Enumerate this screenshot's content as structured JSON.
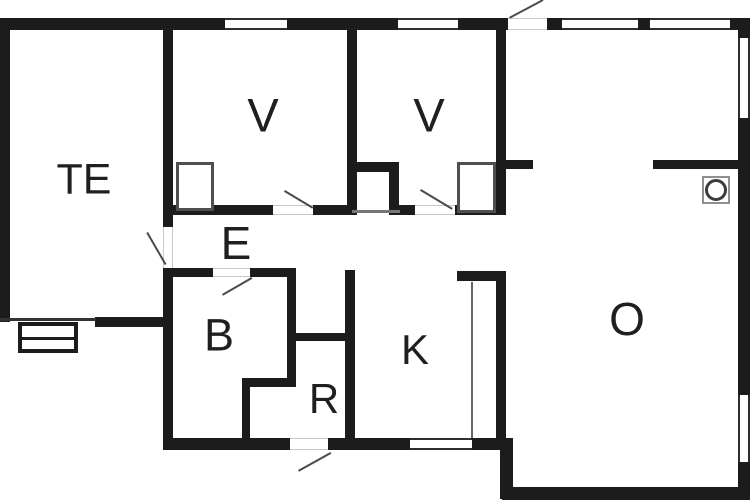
{
  "plan_title": "holiday-house-floor-plan",
  "colors": {
    "wall": "#1c1c1c",
    "background": "#ffffff",
    "window_line": "#2e2e2e",
    "door_gap_line": "#c9c9c9",
    "door_swing": "#4a4a4a",
    "furniture_line": "#4f4f4f",
    "stove_line": "#8f8f8f"
  },
  "rooms": [
    {
      "id": "te",
      "label": "TE"
    },
    {
      "id": "v1",
      "label": "V"
    },
    {
      "id": "v2",
      "label": "V"
    },
    {
      "id": "e",
      "label": "E"
    },
    {
      "id": "b",
      "label": "B"
    },
    {
      "id": "r",
      "label": "R"
    },
    {
      "id": "k",
      "label": "K"
    },
    {
      "id": "o",
      "label": "O"
    }
  ],
  "fixtures": [
    {
      "name": "wood-stove"
    },
    {
      "name": "kitchen-counter"
    },
    {
      "name": "wardrobe-v1"
    },
    {
      "name": "wardrobe-v2"
    },
    {
      "name": "hall-closet"
    },
    {
      "name": "terrace-steps"
    }
  ],
  "counts": {
    "windows": 7,
    "doors": 6
  }
}
